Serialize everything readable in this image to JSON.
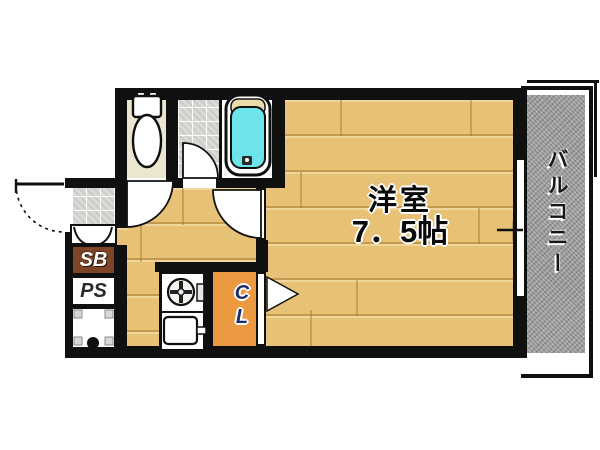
{
  "rooms": {
    "main_room": {
      "name": "洋室",
      "size": "7．5帖"
    },
    "balcony": {
      "label": "バルコニー"
    },
    "closet": {
      "label": "CL"
    },
    "shoe_box": {
      "label": "SB"
    },
    "pipe_shaft": {
      "label": "PS"
    }
  },
  "fixtures": [
    "toilet-icon",
    "bathtub-icon",
    "stove-burner-icon",
    "kitchen-sink-icon",
    "washing-machine-pan-icon",
    "entrance-door-swing",
    "toilet-door-swing",
    "bathroom-door-swing",
    "room-door-swing",
    "closet-door-triangle",
    "sliding-window",
    "genkan-step-curve"
  ],
  "colors": {
    "wall": "#101010",
    "wood_floor": "#e7c276",
    "closet_orange": "#ec9a41",
    "shoe_box_brown": "#7d4426",
    "bathtub_cyan": "#6ce4ea",
    "balcony_gray": "#9c9c9a",
    "toilet_floor_beige": "#eae6d0",
    "tile_gray": "#dadad6",
    "tub_pillow_beige": "#e9dcab"
  }
}
